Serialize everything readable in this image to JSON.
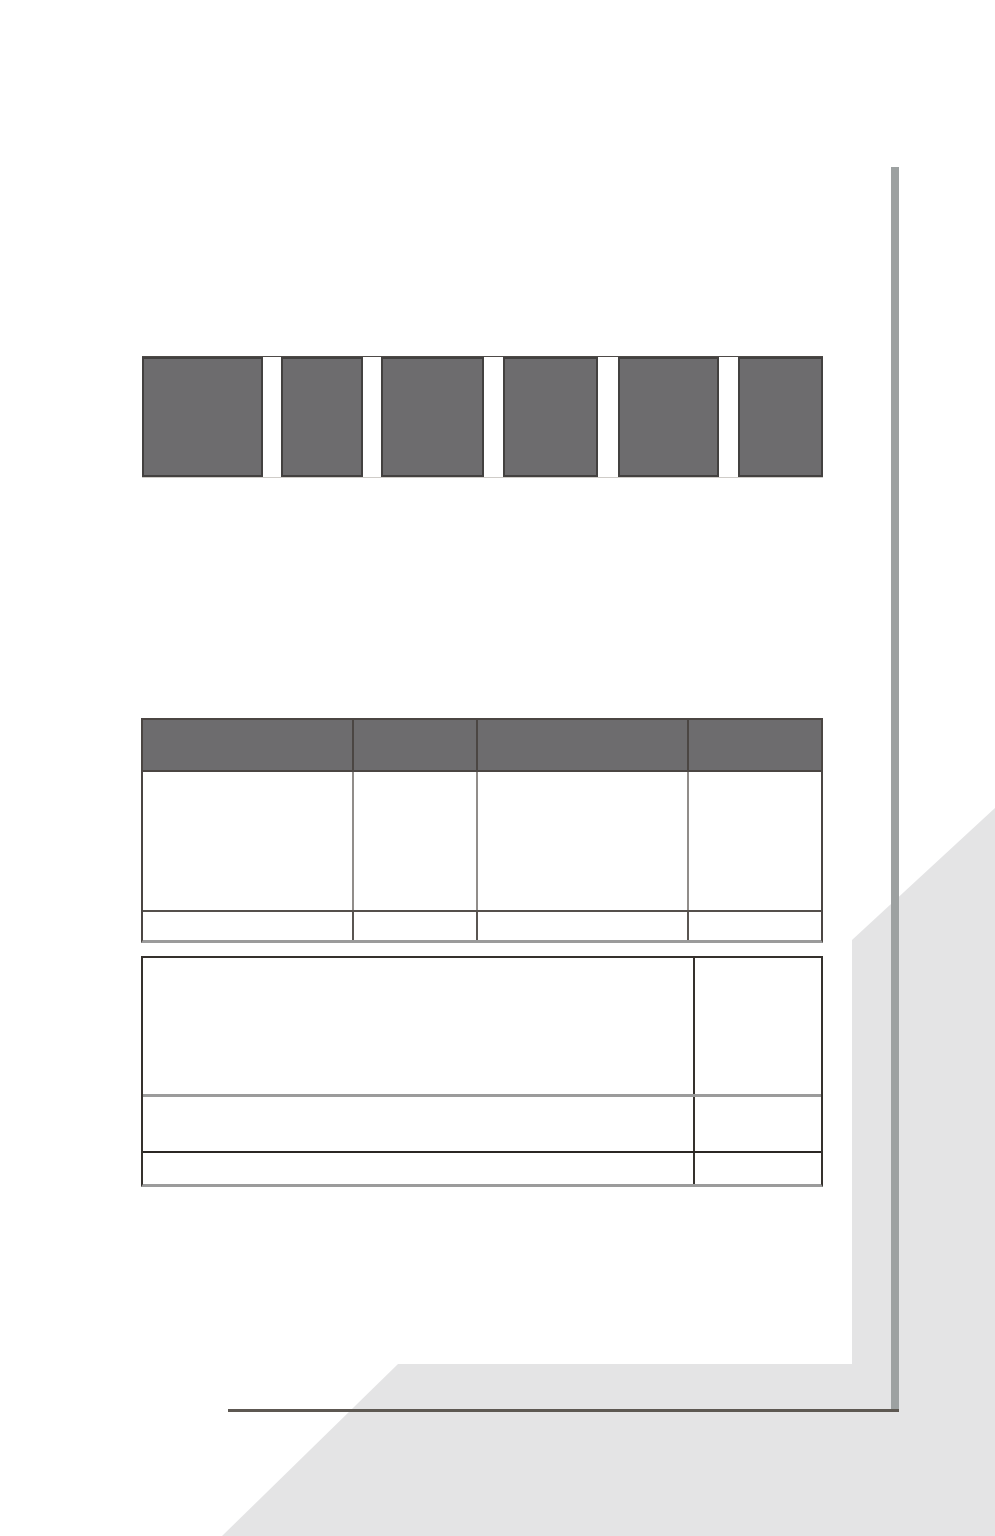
{
  "canvas": {
    "width": 995,
    "height": 1536,
    "background_color": "#ffffff"
  },
  "colors": {
    "page_bg": "#ffffff",
    "block_fill": "#6d6c6e",
    "block_border": "#434140",
    "upper_table_dark_border": "#4b4643",
    "lower_table_dark_border": "#35312d",
    "thick_gray_border": "#9b9b9b",
    "vertical_rule": "#9da1a1",
    "baseline_rule": "#5d5852",
    "corner_ribbon": "#e4e4e5"
  },
  "header_band": {
    "x": 142,
    "y": 356,
    "width": 681,
    "height": 122,
    "block_widths": [
      121,
      82,
      103,
      95,
      101,
      85
    ],
    "gap_widths": [
      18,
      18,
      19,
      20,
      19
    ],
    "block_count": 6
  },
  "upper_table": {
    "x": 141,
    "y": 718,
    "width": 682,
    "height": 225,
    "column_widths": [
      211,
      124,
      211,
      126
    ],
    "header_height": 54,
    "body_row_heights": [
      140,
      31
    ],
    "column_count": 4,
    "header_filled": true
  },
  "lower_table": {
    "x": 141,
    "y": 956,
    "width": 682,
    "height": 231,
    "column_widths": [
      552,
      126
    ],
    "row_heights": [
      139,
      56,
      36
    ],
    "column_count": 2
  },
  "vertical_rule": {
    "x": 891,
    "y_top": 167,
    "y_bottom": 1411,
    "thickness": 8
  },
  "baseline_rule": {
    "x_left": 228,
    "x_right": 899,
    "y": 1409,
    "thickness": 3
  },
  "corner_ribbon": {
    "points": "398,1364 852,1364 852,940 995,808 995,1536 222,1536"
  }
}
